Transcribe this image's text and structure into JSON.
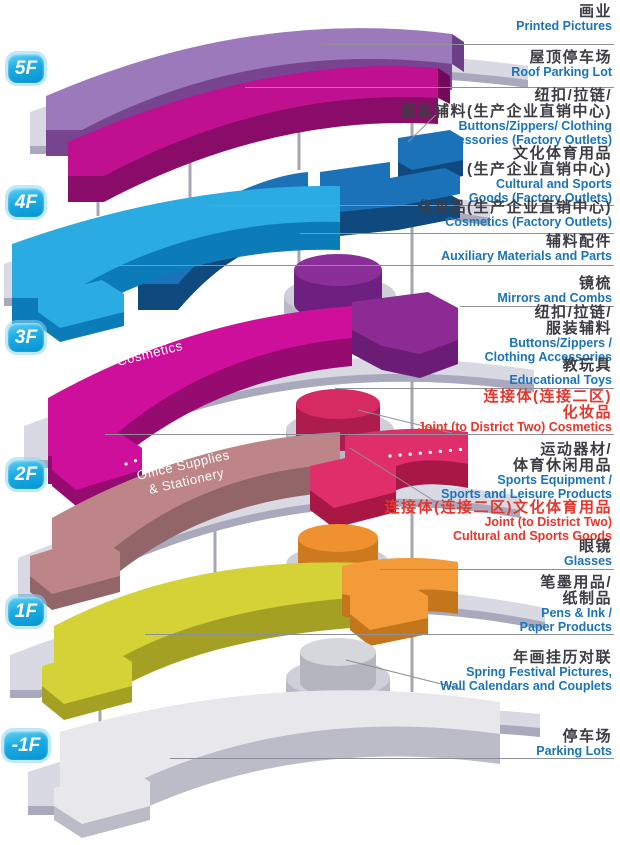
{
  "floors": [
    {
      "badge": "5F"
    },
    {
      "badge": "4F"
    },
    {
      "badge": "3F",
      "floor_text": "Cosmetics"
    },
    {
      "badge": "2F",
      "floor_text_line1": "Office Supplies",
      "floor_text_line2": "& Stationery"
    },
    {
      "badge": "1F"
    },
    {
      "badge": "-1F"
    }
  ],
  "labels": [
    {
      "zh1": "画业",
      "en1": "Printed Pictures"
    },
    {
      "zh1": "屋顶停车场",
      "en1": "Roof Parking Lot"
    },
    {
      "zh1": "纽扣/拉链/",
      "zh2": "服装辅料(生产企业直销中心)",
      "en1": "Buttons/Zippers/ Clothing",
      "en2": "Accessories (Factory Outlets)"
    },
    {
      "zh1": "文化体育用品",
      "zh2": "(生产企业直销中心)",
      "en1": "Cultural and Sports",
      "en2": "Goods (Factory Outlets)"
    },
    {
      "zh1": "化妆品(生产企业直销中心)",
      "en1": "Cosmetics (Factory Outlets)"
    },
    {
      "zh1": "辅料配件",
      "en1": "Auxiliary Materials and Parts"
    },
    {
      "zh1": "镜梳",
      "en1": "Mirrors and Combs"
    },
    {
      "zh1": "纽扣/拉链/",
      "zh2": "服装辅料",
      "en1": "Buttons/Zippers /",
      "en2": "Clothing Accessories"
    },
    {
      "zh1": "教玩具",
      "en1": "Educational Toys"
    },
    {
      "zh1": "连接体(连接二区)",
      "zh2": "化妆品",
      "en1": "Joint (to District Two) Cosmetics"
    },
    {
      "zh1": "运动器材/",
      "zh2": "体育休闲用品",
      "en1": "Sports Equipment /",
      "en2": "Sports and Leisure Products"
    },
    {
      "zh1": "连接体(连接二区)文化体育用品",
      "en1": "Joint (to District Two)",
      "en2": "Cultural and Sports Goods"
    },
    {
      "zh1": "眼镜",
      "en1": "Glasses"
    },
    {
      "zh1": "笔墨用品/",
      "zh2": "纸制品",
      "en1": "Pens & Ink /",
      "en2": "Paper Products"
    },
    {
      "zh1": "年画挂历对联",
      "en1": "Spring Festival Pictures,",
      "en2": "Wall Calendars and Couplets"
    },
    {
      "zh1": "停车场",
      "en1": "Parking Lots"
    }
  ],
  "colors": {
    "badge_cyan": "#1cabe3",
    "label_blue": "#1b74b8",
    "label_red": "#e8342b",
    "label_dark": "#3c3c42",
    "floor_5f_purple": "#9b79bb",
    "floor_5f_magenta": "#bf1090",
    "floor_4f_cyan": "#2aabe2",
    "floor_4f_blue": "#1b72b8",
    "floor_3f_magenta": "#ce0f9b",
    "floor_3f_purple": "#8d2b95",
    "floor_2f_rose": "#bd8588",
    "floor_2f_crimson": "#e02e6b",
    "floor_1f_yellow": "#d5d238",
    "floor_1f_orange": "#f29b38",
    "floor_b1_gray": "#e8e8ec",
    "base_plate": "#d9d9e3"
  }
}
